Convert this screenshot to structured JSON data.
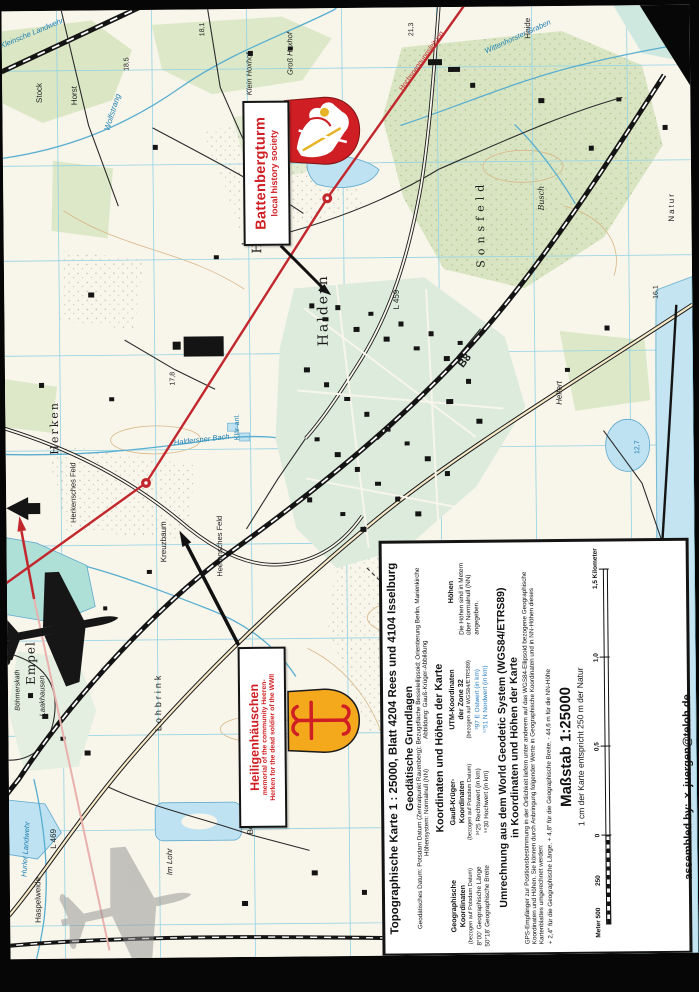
{
  "annotations": {
    "battenbergturm": {
      "title": "Battenbergturm",
      "subtitle": "local history society"
    },
    "heiligenhaeuschen": {
      "title": "Heiligenhäuschen",
      "subtitle1": "memorial of the community Heeren-",
      "subtitle2": "Herken for the dead soldier of the WWII"
    }
  },
  "credit": {
    "label": "assembled by:",
    "mark": "×",
    "value": "juergen@teloh.de"
  },
  "info_box": {
    "title": "Topographische Karte 1 : 25000,  Blatt  4204 Rees und  4104 Isselburg",
    "geodaetische": {
      "heading": "Geodätische Grundlagen",
      "line1": "Geodätisches Datum: Potsdam Datum (Zentralpunkt Rauenberg); Bezugsfläche Besselellipsoid; Orientierung Berlin, Marienkirche",
      "line2_left": "Höhensystem: Normalnull (NN)",
      "line2_right": "Abbildung: Gauß-Krüger-Abbildung"
    },
    "koordinaten": {
      "heading": "Koordinaten und Höhen der Karte",
      "columns": [
        {
          "name1": "Geographische",
          "name2": "Koordinaten",
          "ref": "(bezogen auf Potsdam Datum)",
          "row1": "8°00' Geographische Länge",
          "row2": "50°18' Geographische Breite"
        },
        {
          "name1": "Gauß-Krüger-",
          "name2": "Koordinaten",
          "ref": "(bezogen auf Potsdam Datum)",
          "row1": "³⁴25  Rechtswert (in km)",
          "row2": "⁵⁶30  Hochwert (in km)"
        },
        {
          "name1": "UTM-Koordinaten",
          "name2": "der Zone 32",
          "ref": "(bezogen auf WGS84/ETRS89)",
          "row1": "³97 E  Ostwert (in km)",
          "row2": "⁵⁷51 N  Nordwert (in km)",
          "value_color": "#2a7fc1"
        },
        {
          "name1": "Höhen",
          "name2": "",
          "ref": "",
          "row1": "Die Höhen sind in Metern über Normalnull (NN) angegeben.",
          "row2": ""
        }
      ]
    },
    "umrechnung": {
      "heading1": "Umrechnung aus dem World Geodetic System (WGS84/ETRS89)",
      "heading2": "in Koordinaten und Höhen der Karte",
      "body": "GPS-Empfänger zur Positionsbestimmung in der Örtlichkeit liefern unter anderem auf das WGS84-Ellipsoid bezogene Geographische Koordinaten und Höhen. Sie können durch Anbringung folgender Werte in Geographische Koordinaten und in NN-Höhen dieses Kartenblattes umgerechnet werden:",
      "values": "+ 2,4\" für die Geographische Länge,  + 4,8\" für die Geographische Breite,  - 44,6 m für die NN-Höhe"
    },
    "massstab": {
      "heading": "Maßstab 1:25000",
      "sub": "1 cm der Karte entspricht 250 m der Natur",
      "bar_labels": {
        "meter": "Meter 500",
        "m250": "250",
        "zero": "0",
        "k05": "0,5",
        "k10": "1,0",
        "k15": "1,5 Kilometer"
      }
    }
  },
  "map": {
    "colors": {
      "k": "#1a1a1a",
      "b": "#1d7fb0",
      "r": "#c1272d"
    },
    "labels": [
      {
        "t": "Haldern",
        "x": 319,
        "y": 302,
        "r": -90,
        "s": 14,
        "c": "k",
        "sp": 2,
        "f": "serif"
      },
      {
        "t": "Empel",
        "x": 23,
        "y": 652,
        "r": -90,
        "s": 12,
        "c": "k",
        "sp": 1,
        "f": "serif"
      },
      {
        "t": "Herken",
        "x": 49,
        "y": 417,
        "r": -90,
        "s": 11,
        "c": "k",
        "sp": 2,
        "f": "serif"
      },
      {
        "t": "Lohbrink",
        "x": 150,
        "y": 692,
        "r": -90,
        "s": 9,
        "c": "k",
        "sp": 3
      },
      {
        "t": "Sonsfeld",
        "x": 477,
        "y": 217,
        "r": -90,
        "s": 11,
        "c": "k",
        "sp": 5,
        "f": "serif"
      },
      {
        "t": "Busch",
        "x": 538,
        "y": 192,
        "r": -90,
        "s": 8,
        "c": "k",
        "f": "serif",
        "i": 1
      },
      {
        "t": "Heide",
        "x": 526,
        "y": 22,
        "r": -90,
        "s": 8,
        "c": "k"
      },
      {
        "t": "Wolfstrang",
        "x": 110,
        "y": 102,
        "r": -72,
        "s": 8,
        "c": "b",
        "i": 1
      },
      {
        "t": "Wittenhorster Graben",
        "x": 516,
        "y": 30,
        "r": -24,
        "s": 7.5,
        "c": "b",
        "i": 1
      },
      {
        "t": "Haldersner Bach",
        "x": 196,
        "y": 430,
        "r": -6,
        "s": 7.5,
        "c": "b",
        "i": 1
      },
      {
        "t": "Hurler Landwehr",
        "x": 16,
        "y": 838,
        "r": -86,
        "s": 7.5,
        "c": "b",
        "i": 1
      },
      {
        "t": "Kreuzbaum",
        "x": 157,
        "y": 532,
        "r": -90,
        "s": 8,
        "c": "k"
      },
      {
        "t": "Herkensches Feld",
        "x": 67,
        "y": 482,
        "r": -90,
        "s": 7.5,
        "c": "k"
      },
      {
        "t": "Heerensches Feld",
        "x": 213,
        "y": 537,
        "r": -90,
        "s": 7.5,
        "c": "k"
      },
      {
        "t": "B8",
        "x": 460,
        "y": 354,
        "r": -52,
        "s": 11,
        "c": "k",
        "bold": 1
      },
      {
        "t": "L 459",
        "x": 392,
        "y": 292,
        "r": -90,
        "s": 8,
        "c": "k"
      },
      {
        "t": "L 469",
        "x": 44,
        "y": 828,
        "r": -90,
        "s": 8,
        "c": "k"
      },
      {
        "t": "Haspelweide",
        "x": 28,
        "y": 889,
        "r": -90,
        "s": 8,
        "c": "k"
      },
      {
        "t": "Im Lohr",
        "x": 160,
        "y": 852,
        "r": -90,
        "s": 8,
        "c": "k",
        "i": 1
      },
      {
        "t": "Laakhausen",
        "x": 34,
        "y": 685,
        "r": -90,
        "s": 7.5,
        "c": "k",
        "i": 1
      },
      {
        "t": "Klein Hoxhof",
        "x": 247,
        "y": 65,
        "r": -90,
        "s": 7.5,
        "c": "k",
        "i": 1
      },
      {
        "t": "Groß Hoxhof",
        "x": 288,
        "y": 45,
        "r": -90,
        "s": 7.5,
        "c": "k",
        "i": 1
      },
      {
        "t": "Stock",
        "x": 37,
        "y": 82,
        "r": -90,
        "s": 8,
        "c": "k"
      },
      {
        "t": "Horst",
        "x": 72,
        "y": 85,
        "r": -90,
        "s": 8,
        "c": "k"
      },
      {
        "t": "Kleinsche Landwehr",
        "x": 30,
        "y": 22,
        "r": -22,
        "s": 7.5,
        "c": "b",
        "i": 1
      },
      {
        "t": "Klär-anl.",
        "x": 232,
        "y": 418,
        "r": -90,
        "s": 7,
        "c": "b"
      },
      {
        "t": "Natur",
        "x": 668,
        "y": 202,
        "r": -90,
        "s": 8,
        "c": "k",
        "sp": 2
      },
      {
        "t": "18,5",
        "x": 125,
        "y": 54,
        "r": -90,
        "s": 7,
        "c": "k"
      },
      {
        "t": "21,3",
        "x": 410,
        "y": 22,
        "r": -90,
        "s": 7,
        "c": "k"
      },
      {
        "t": "18,1",
        "x": 201,
        "y": 20,
        "r": -90,
        "s": 7,
        "c": "k"
      },
      {
        "t": "17,8",
        "x": 168,
        "y": 369,
        "r": -90,
        "s": 7,
        "c": "k"
      },
      {
        "t": "12,7",
        "x": 632,
        "y": 442,
        "r": -90,
        "s": 7,
        "c": "b"
      },
      {
        "t": "16,1",
        "x": 652,
        "y": 287,
        "r": -90,
        "s": 7,
        "c": "k"
      },
      {
        "t": "Heerloh",
        "x": 254,
        "y": 197,
        "r": -90,
        "s": 13,
        "c": "k",
        "sp": 6,
        "f": "serif"
      },
      {
        "t": "Böhmerskath",
        "x": 10,
        "y": 679,
        "r": -90,
        "s": 7,
        "c": "k",
        "i": 1
      },
      {
        "t": "Berg",
        "x": 241,
        "y": 817,
        "r": -90,
        "s": 8,
        "c": "k"
      },
      {
        "t": "Helfert",
        "x": 554,
        "y": 387,
        "r": -90,
        "s": 8,
        "c": "k",
        "i": 1
      },
      {
        "t": "Hochspannungsleitung",
        "x": 420,
        "y": 54,
        "r": -54,
        "s": 7,
        "c": "r"
      }
    ]
  }
}
